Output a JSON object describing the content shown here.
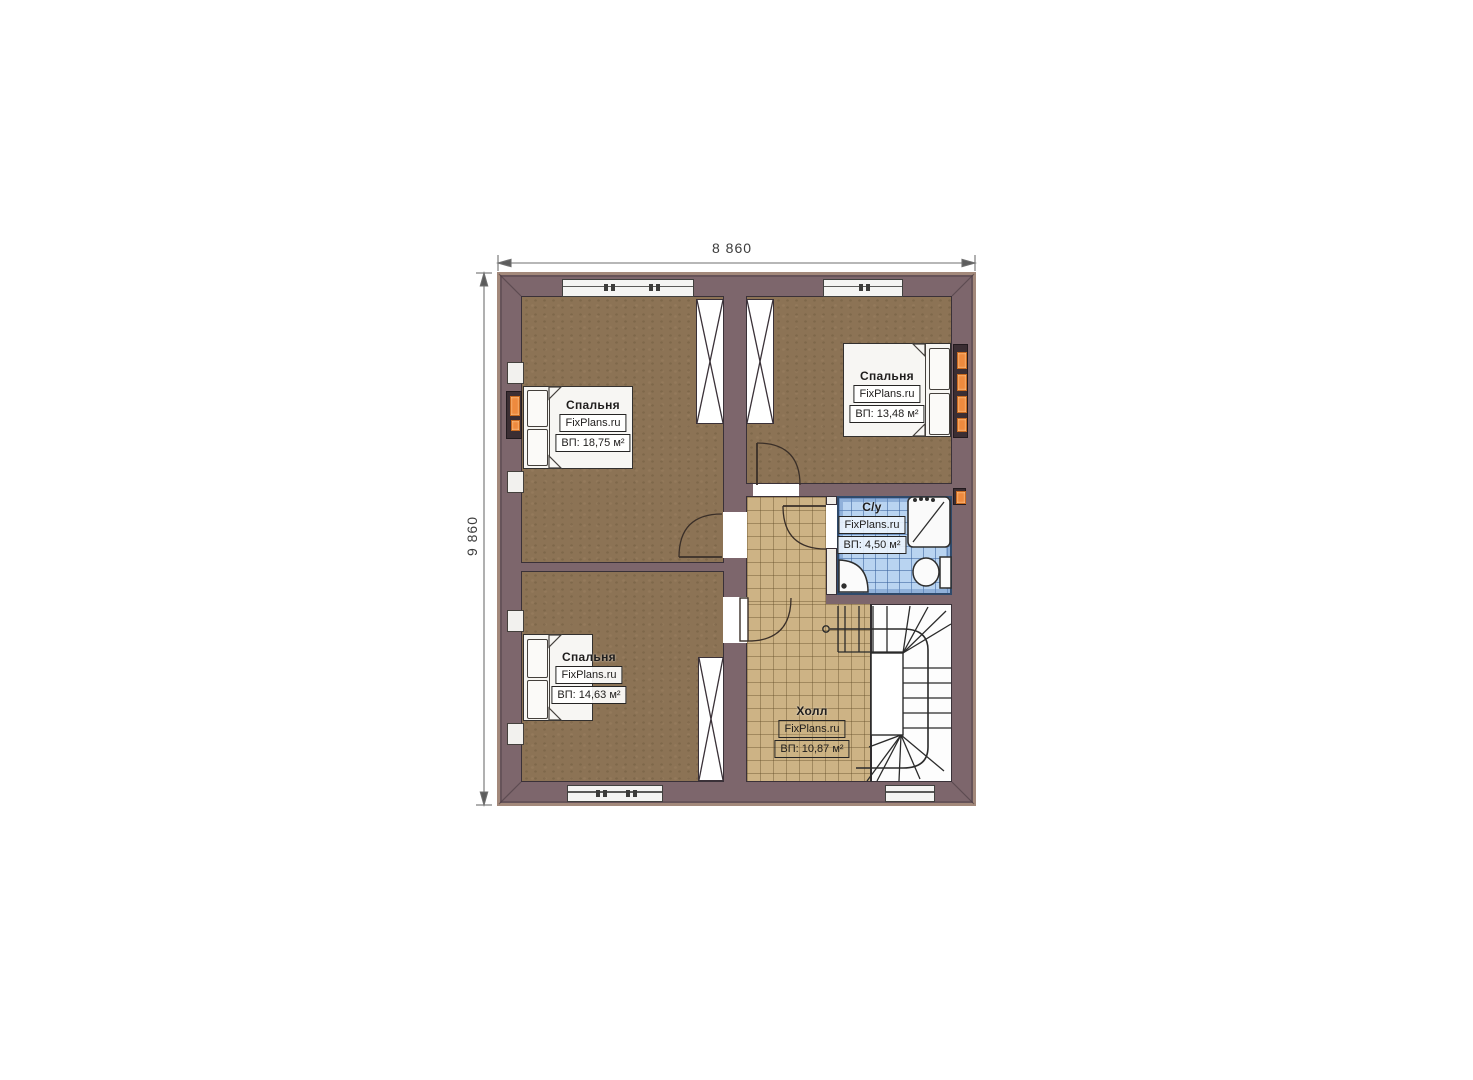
{
  "dimensions": {
    "width": "8 860",
    "height": "9 860"
  },
  "rooms": {
    "bedroom_top_left": {
      "name": "Спальня",
      "brand": "FixPlans.ru",
      "area": "ВП: 18,75 м²"
    },
    "bedroom_top_right": {
      "name": "Спальня",
      "brand": "FixPlans.ru",
      "area": "ВП: 13,48 м²"
    },
    "bathroom": {
      "name": "С/у",
      "brand": "FixPlans.ru",
      "area": "ВП: 4,50 м²"
    },
    "bedroom_bottom_left": {
      "name": "Спальня",
      "brand": "FixPlans.ru",
      "area": "ВП: 14,63 м²"
    },
    "hall": {
      "name": "Холл",
      "brand": "FixPlans.ru",
      "area": "ВП: 10,87 м²"
    }
  },
  "colors": {
    "wall": "#7d666c",
    "wall_trim": "#a3897b",
    "bedroom_floor": "#8c7355",
    "hall_floor": "#cdb385",
    "bath_tile": "#b9d4f1",
    "accent_orange": "#ee8a3e",
    "line": "#3a3138"
  }
}
